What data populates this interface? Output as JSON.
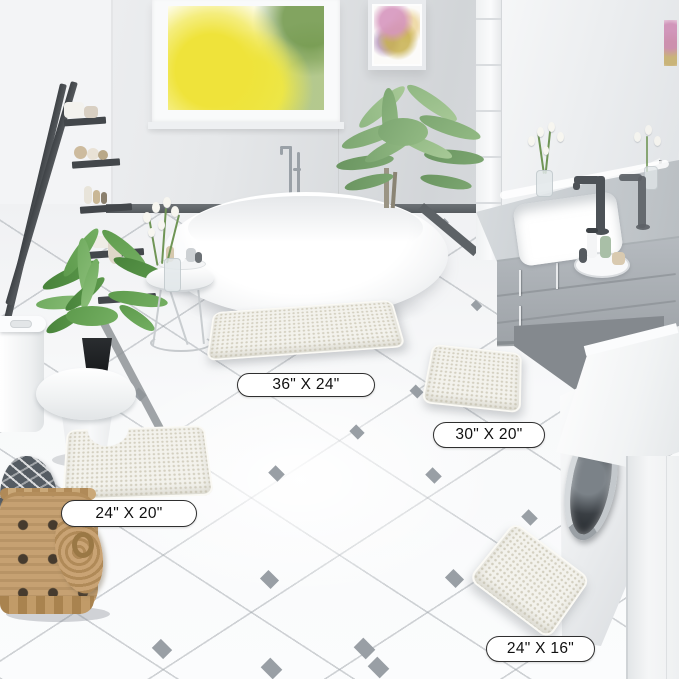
{
  "scene_title": "Bathroom bath mat set product photo",
  "labels": {
    "mat_36x24": "36\" X 24\"",
    "mat_30x20": "30\" X 20\"",
    "mat_24x20": "24\" X 20\"",
    "mat_24x16": "24\" X 16\""
  },
  "colors": {
    "mat": "#f3f2ec",
    "label_border": "#2f2f2f",
    "label_background": "#ffffff",
    "floor_accent": "#999fa5",
    "ladder": "#4a4e52",
    "vanity": "#aeb3b8",
    "wall": "#e9ebed",
    "window_foliage": "#efe33a",
    "basket": "#c6a172"
  }
}
